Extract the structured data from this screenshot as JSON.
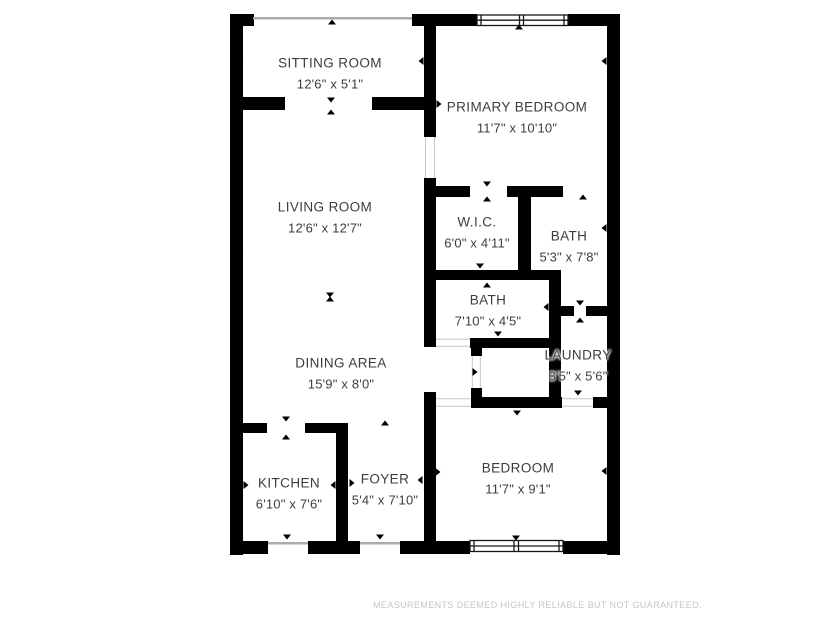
{
  "floorplan": {
    "rooms": [
      {
        "name": "SITTING ROOM",
        "dims": "12'6\" x 5'1\""
      },
      {
        "name": "PRIMARY BEDROOM",
        "dims": "11'7\" x 10'10\""
      },
      {
        "name": "LIVING ROOM",
        "dims": "12'6\" x 12'7\""
      },
      {
        "name": "W.I.C.",
        "dims": "6'0\" x 4'11\""
      },
      {
        "name": "BATH",
        "dims": "5'3\" x 7'8\""
      },
      {
        "name": "BATH",
        "dims": "7'10\" x 4'5\""
      },
      {
        "name": "LAUNDRY",
        "dims": "3'5\" x 5'6\""
      },
      {
        "name": "DINING AREA",
        "dims": "15'9\" x 8'0\""
      },
      {
        "name": "KITCHEN",
        "dims": "6'10\" x 7'6\""
      },
      {
        "name": "FOYER",
        "dims": "5'4\" x 7'10\""
      },
      {
        "name": "BEDROOM",
        "dims": "11'7\" x 9'1\""
      }
    ],
    "colors": {
      "wall": "#000000",
      "label_text": "#3d3d3d",
      "opening_line": "#c6c6c6",
      "disclaimer_text": "#c6c6c6",
      "background": "#ffffff"
    }
  },
  "footer": {
    "disclaimer": "MEASUREMENTS DEEMED HIGHLY RELIABLE BUT NOT GUARANTEED."
  }
}
